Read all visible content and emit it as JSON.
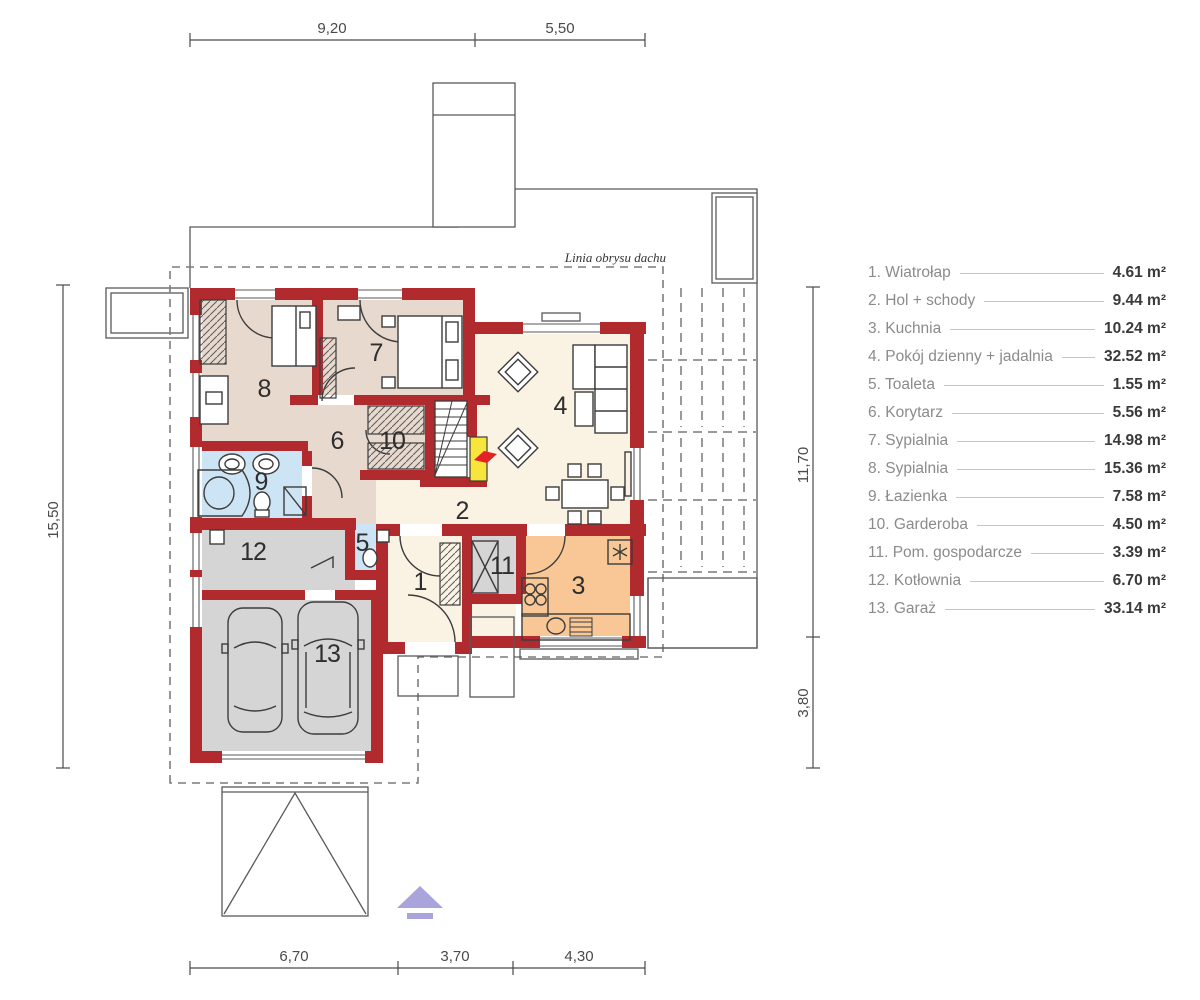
{
  "roof_outline_label": "Linia obrysu dachu",
  "dimensions": {
    "top": [
      "9,20",
      "5,50"
    ],
    "bottom": [
      "6,70",
      "3,70",
      "4,30"
    ],
    "left": [
      "15,50"
    ],
    "right_upper": "11,70",
    "right_lower": "3,80"
  },
  "room_numbers": [
    "1",
    "2",
    "3",
    "4",
    "5",
    "6",
    "7",
    "8",
    "9",
    "10",
    "11",
    "12",
    "13"
  ],
  "legend": {
    "items": [
      {
        "label": "1. Wiatrołap",
        "area": "4.61 m²"
      },
      {
        "label": "2. Hol + schody",
        "area": "9.44 m²"
      },
      {
        "label": "3. Kuchnia",
        "area": "10.24 m²"
      },
      {
        "label": "4. Pokój dzienny + jadalnia",
        "area": "32.52 m²"
      },
      {
        "label": "5. Toaleta",
        "area": "1.55 m²"
      },
      {
        "label": "6. Korytarz",
        "area": "5.56 m²"
      },
      {
        "label": "7. Sypialnia",
        "area": "14.98 m²"
      },
      {
        "label": "8. Sypialnia",
        "area": "15.36 m²"
      },
      {
        "label": "9. Łazienka",
        "area": "7.58 m²"
      },
      {
        "label": "10. Garderoba",
        "area": "4.50 m²"
      },
      {
        "label": "11. Pom. gospodarcze",
        "area": "3.39 m²"
      },
      {
        "label": "12. Kotłownia",
        "area": "6.70 m²"
      },
      {
        "label": "13. Garaż",
        "area": "33.14 m²"
      }
    ]
  },
  "colors": {
    "wall": "#b02a2e",
    "bedroom_fill": "#e7d9ce",
    "living_fill": "#faf3e3",
    "bath_fill": "#cde4f4",
    "garage_fill": "#d5d5d5",
    "kitchen_fill": "#f8c795",
    "stairs_highlight": "#f7e53b",
    "entrance_arrow": "#aaa4dd"
  }
}
